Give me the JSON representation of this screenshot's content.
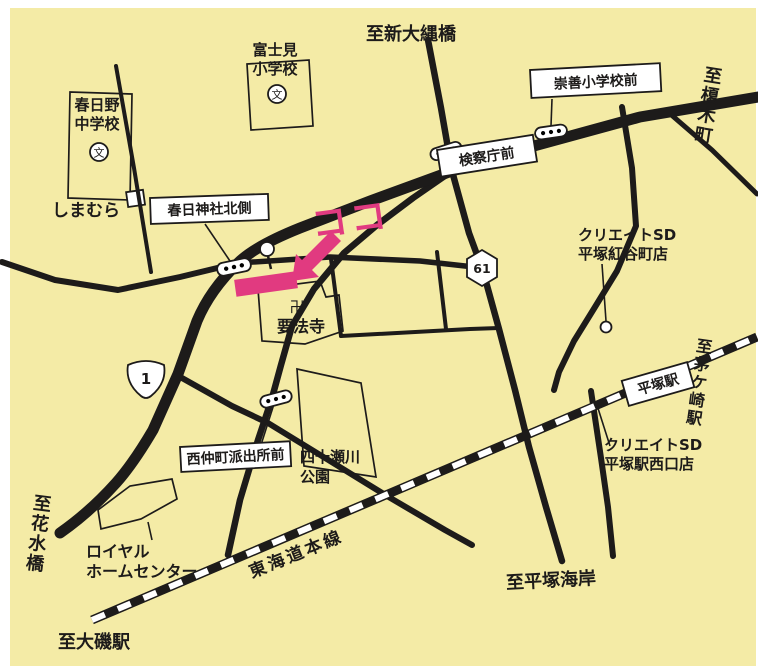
{
  "map": {
    "background_color": "#f4eba6",
    "ink_color": "#1d1b1a",
    "accent_color": "#e13a80"
  },
  "labels": {
    "koko": "ココ",
    "to_shin_onawabashi": "至新大縄橋",
    "to_enokicho": "至榎木町",
    "to_chigasaki_station": "至茅ケ崎駅",
    "to_hanamizubashi": "至花水橋",
    "to_oiso_station": "至大磯駅",
    "to_hiratsuka_kaigan": "至平塚海岸",
    "tokaido_main_line": "東海道本線",
    "hiratsuka_station": "平塚駅",
    "kasuga_jinja_kitagawa": "春日神社北側",
    "kensatsucho_mae": "検察庁前",
    "suzen_shogakko_mae": "崇善小学校前",
    "nishinakacho_hashutsujo_mae": "西仲町派出所前",
    "fujimi_line1": "富士見",
    "fujimi_line2": "小学校",
    "kasugano_line1": "春日野",
    "kasugano_line2": "中学校",
    "school_mark": "文",
    "shimamura": "しまむら",
    "manji": "卍",
    "temple_name": "要法寺",
    "park_line1": "四十瀬川",
    "park_line2": "公園",
    "royal_line1": "ロイヤル",
    "royal_line2": "ホームセンター",
    "create_beniya_line1": "クリエイトSD",
    "create_beniya_line2": "平塚紅谷町店",
    "create_west_line1": "クリエイトSD",
    "create_west_line2": "平塚駅西口店",
    "route_1": "1",
    "route_61": "61"
  }
}
